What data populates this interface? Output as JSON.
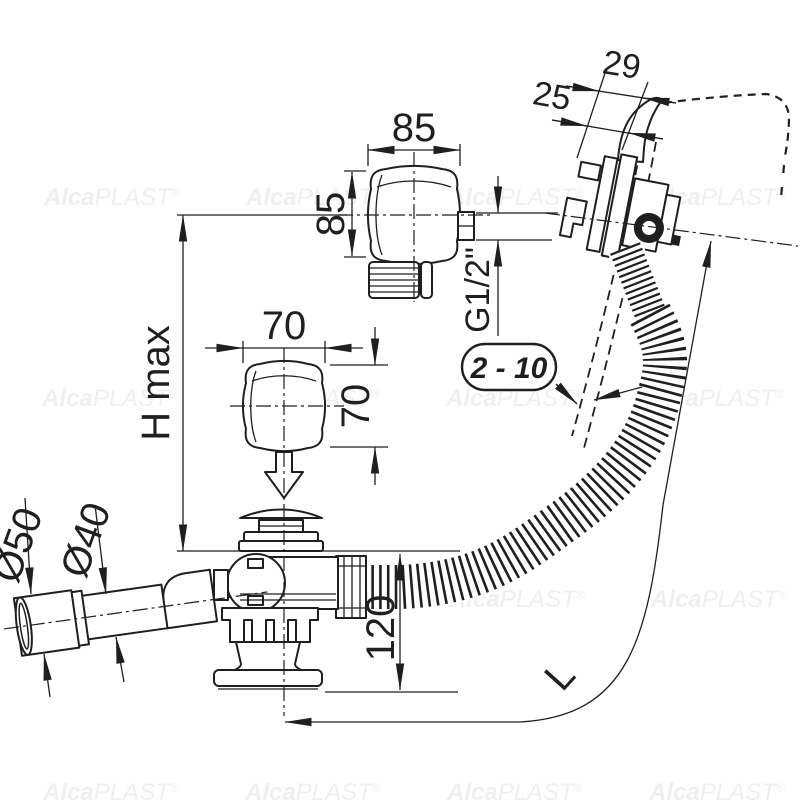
{
  "watermark": {
    "bold": "Alca",
    "light": "PLAST",
    "reg": "®"
  },
  "dims": {
    "overflow_trim_width": "85",
    "overflow_trim_height": "85",
    "thread_size": "G1/2\"",
    "rim_offset_outer": "29",
    "rim_offset_inner": "25",
    "wall_thickness_range": "2 - 10",
    "drain_trim_width": "70",
    "drain_trim_height": "70",
    "height_max": "H max",
    "drain_height": "120",
    "hose_length": "L",
    "outlet_outer_dia": "Ø50",
    "outlet_inner_dia": "Ø40"
  },
  "colors": {
    "line": "#1f1f1f",
    "watermark": "#efefef",
    "background": "#ffffff"
  }
}
